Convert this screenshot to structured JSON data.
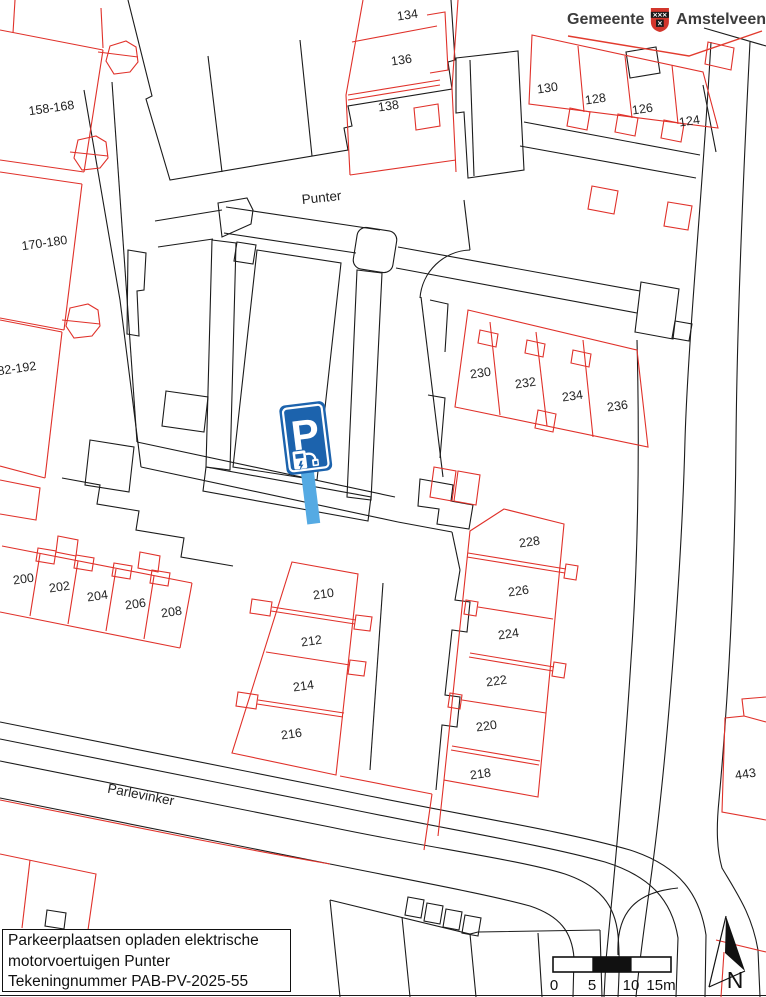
{
  "logo": {
    "municipality": "Gemeente",
    "city": "Amstelveen"
  },
  "map": {
    "streets": {
      "punter": "Punter",
      "parlevinker": "Parlevinker"
    },
    "house_numbers": {
      "n134": "134",
      "n136": "136",
      "n138": "138",
      "n130": "130",
      "n128": "128",
      "n126": "126",
      "n124": "124",
      "r158": "158-168",
      "r170": "170-180",
      "r182": "182-192",
      "n230": "230",
      "n232": "232",
      "n234": "234",
      "n236": "236",
      "n228": "228",
      "n226": "226",
      "n224": "224",
      "n222": "222",
      "n220": "220",
      "n218": "218",
      "n200": "200",
      "n202": "202",
      "n204": "204",
      "n206": "206",
      "n208": "208",
      "n210": "210",
      "n212": "212",
      "n214": "214",
      "n216": "216",
      "n443": "443"
    },
    "parking_sign": {
      "letter": "P"
    }
  },
  "title_block": {
    "line1": "Parkeerplaatsen opladen elektrische",
    "line2": "motorvoertuigen Punter",
    "line3": "Tekeningnummer PAB-PV-2025-55"
  },
  "scale_bar": {
    "labels": [
      "0",
      "5",
      "10",
      "15m"
    ]
  },
  "compass": {
    "label": "N"
  },
  "colors": {
    "parcel_red": "#e0312a",
    "line_black": "#1b1b1b",
    "sign_blue": "#1c63ad",
    "pole_blue": "#55aae3",
    "logo_red": "#e23b2e"
  }
}
